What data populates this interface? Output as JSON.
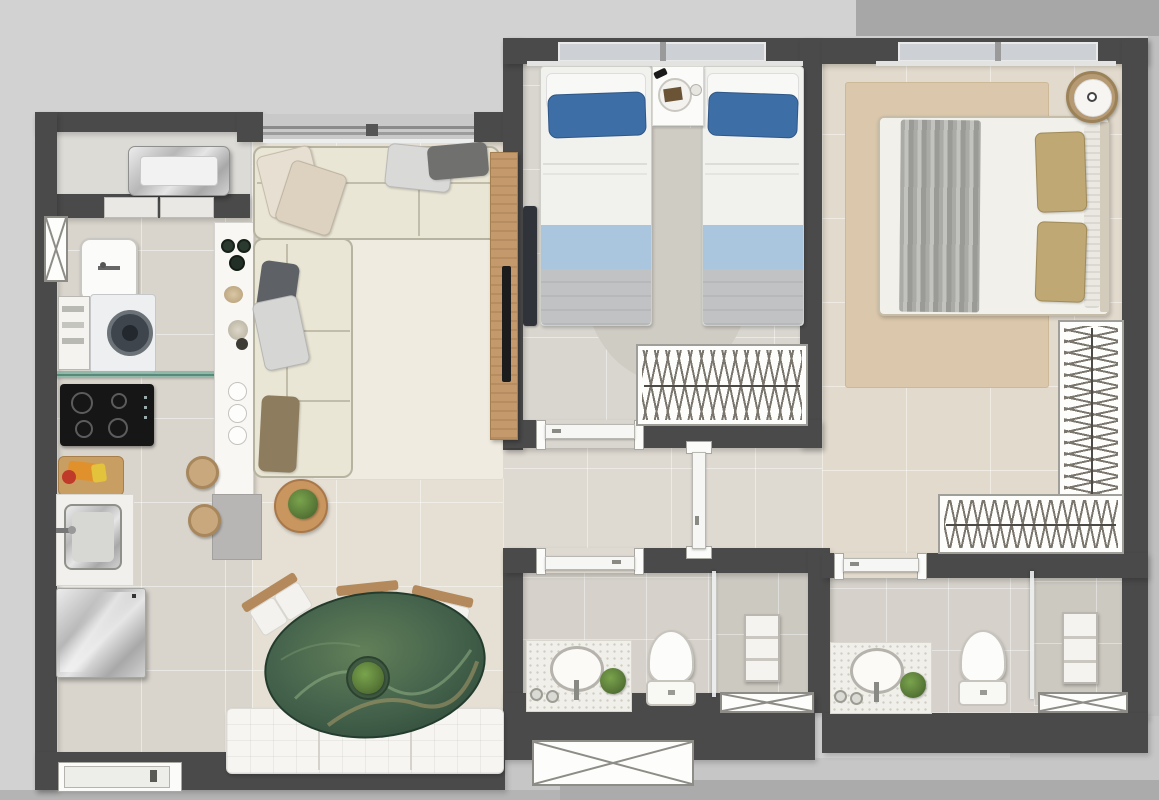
{
  "meta": {
    "title": "Apartment floor plan — top-down 3D render",
    "type": "floor-plan",
    "text_visible": "none"
  },
  "palette": {
    "background": "#d2d2d2",
    "background_dark_band": "#a7a7a7",
    "walls": "#4a4a4a",
    "floor_living": "#e5dfd4",
    "floor_kitchen": "#d9d5cd",
    "floor_bedroom": "#d9d6cf",
    "floor_master": "#e2dacc",
    "floor_hall": "#ded9d1",
    "floor_bath": "#d6d2cb",
    "floor_bath_wet": "#ccc9c1",
    "rug_living": "#efebe0",
    "rug_master": "#dbc8ac",
    "rug_bedroom": "#cfccc4",
    "sofa": "#eae6d6",
    "accent_blue": "#3e6ea6",
    "accent_light_blue": "#a9c6de",
    "blanket_gray": "#c0c2c4",
    "table_green": "#45634c",
    "wood": "#c49a6c",
    "pillow_gold": "#bfa873",
    "fixture_white": "#f6f6f4"
  },
  "rooms": {
    "balcony": {
      "label": "Service balcony with AC condenser"
    },
    "laundry": {
      "label": "Laundry area"
    },
    "kitchen": {
      "label": "Kitchen"
    },
    "living": {
      "label": "Living room"
    },
    "dining": {
      "label": "Dining area"
    },
    "hallway": {
      "label": "Hallway"
    },
    "bedroom_twin": {
      "label": "Twin bedroom"
    },
    "bedroom_master": {
      "label": "Master bedroom"
    },
    "closet": {
      "label": "L-shaped closet"
    },
    "bathroom_1": {
      "label": "Bathroom 1"
    },
    "bathroom_2": {
      "label": "Bathroom 2"
    }
  },
  "furniture": {
    "balcony": [
      "ac-condenser-unit",
      "ledge-shelves"
    ],
    "laundry": [
      "laundry-sink",
      "washing-machine",
      "shelf-unit"
    ],
    "kitchen": [
      "glass-shelf",
      "cooktop-4-burners",
      "cutting-board-with-food",
      "stainless-sink",
      "refrigerator",
      "island-counter",
      "two-bar-stools",
      "decor-bowls",
      "flower-decor",
      "round-plates"
    ],
    "living": [
      "l-shaped-sofa",
      "seven-throw-pillows",
      "area-rug",
      "round-side-table-with-plant",
      "wood-tv-panel",
      "flat-tv"
    ],
    "dining": [
      "oval-green-marble-table",
      "centerpiece-plant",
      "three-chairs",
      "white-tufted-bench"
    ],
    "bedroom_twin": [
      "twin-bed-left",
      "twin-bed-right",
      "nightstand-with-tray",
      "wall-tv",
      "wardrobe-with-hangers",
      "round-rug"
    ],
    "bedroom_master": [
      "double-bed",
      "gray-throw-blanket",
      "two-gold-pillows",
      "round-rattan-side-table",
      "beige-rug",
      "l-shaped-closet-with-hangers"
    ],
    "bathroom_1": [
      "vanity-counter-with-basin",
      "toilet",
      "glass-shower-partition",
      "shower-niche",
      "plant",
      "candles"
    ],
    "bathroom_2": [
      "vanity-counter-with-basin",
      "toilet",
      "glass-shower-partition",
      "shower-niche",
      "plant",
      "candles"
    ],
    "symbols": [
      "window-glazing",
      "door-leaf-open",
      "duct-shaft-x-box",
      "entry-door"
    ]
  }
}
